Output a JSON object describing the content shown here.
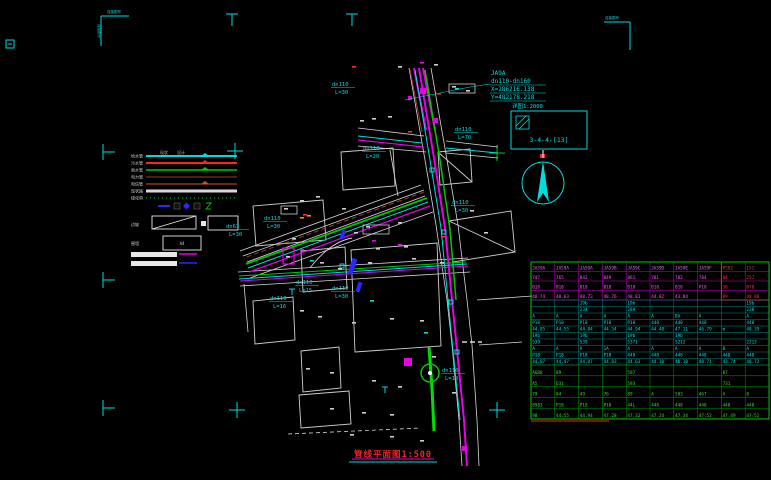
{
  "canvas": {
    "width": 771,
    "height": 480,
    "bg": "#000000"
  },
  "colors": {
    "cyan": "#00dcdc",
    "magenta": "#e800e8",
    "green": "#00c800",
    "red": "#ff2424",
    "white": "#dcdcdc",
    "blue": "#2828ff",
    "darkred": "#9a3b26",
    "orange": "#ff8c00"
  },
  "sheet": {
    "corner_label": "连接图号",
    "title": "管线平面图1:500"
  },
  "annotation": {
    "line1": "JA9A",
    "line2": "dn110-dn160",
    "line3": "X=286216.138",
    "line4": "Y=482178.218"
  },
  "detail_box": {
    "title": "详图1:2000",
    "code": "3-4-4-[13]"
  },
  "legend": {
    "headers": [
      "现状",
      "设计"
    ],
    "rows": [
      {
        "label": "给水管",
        "color": "#00dcdc",
        "w": 2,
        "dash": "",
        "marker": true
      },
      {
        "label": "污水管",
        "color": "#ff2424",
        "w": 2,
        "dash": "",
        "marker": true
      },
      {
        "label": "雨水管",
        "color": "#00c800",
        "w": 1.5,
        "dash": "",
        "marker": true
      },
      {
        "label": "电力管",
        "color": "#9a3b26",
        "w": 1,
        "dash": ""
      },
      {
        "label": "电信管",
        "color": "#d05028",
        "w": 1,
        "dash": "",
        "marker": true
      },
      {
        "label": "现状路",
        "color": "#d8d8d8",
        "w": 3,
        "dash": ""
      },
      {
        "label": "绿化带",
        "color": "#00b000",
        "w": 1.2,
        "dash": "1 3"
      }
    ],
    "box_row_label": "边坡",
    "wall_row_label": "围墙",
    "wall_box_text": "A4"
  },
  "pipe_labels": [
    {
      "d": "dn110",
      "l": "L=30",
      "x": 332,
      "y": 86
    },
    {
      "d": "dn110",
      "l": "L=20",
      "x": 363,
      "y": 150
    },
    {
      "d": "dn110",
      "l": "L=70",
      "x": 455,
      "y": 131
    },
    {
      "d": "dn110",
      "l": "L=30",
      "x": 264,
      "y": 220
    },
    {
      "d": "dn63",
      "l": "L=30",
      "x": 226,
      "y": 228
    },
    {
      "d": "dn110",
      "l": "L=15",
      "x": 296,
      "y": 284
    },
    {
      "d": "dn110",
      "l": "L=30",
      "x": 332,
      "y": 290
    },
    {
      "d": "dn110",
      "l": "L=30",
      "x": 452,
      "y": 204
    },
    {
      "d": "dn110",
      "l": "L=16",
      "x": 270,
      "y": 300
    },
    {
      "d": "dn110",
      "l": "L=10",
      "x": 442,
      "y": 372
    }
  ],
  "specks": {
    "white": [
      [
        360,
        120
      ],
      [
        372,
        118
      ],
      [
        388,
        116
      ],
      [
        300,
        200
      ],
      [
        316,
        196
      ],
      [
        342,
        208
      ],
      [
        354,
        232
      ],
      [
        398,
        222
      ],
      [
        404,
        246
      ],
      [
        376,
        248
      ],
      [
        286,
        256
      ],
      [
        320,
        262
      ],
      [
        338,
        268
      ],
      [
        368,
        262
      ],
      [
        412,
        258
      ],
      [
        440,
        262
      ],
      [
        300,
        310
      ],
      [
        318,
        316
      ],
      [
        352,
        322
      ],
      [
        390,
        318
      ],
      [
        420,
        320
      ],
      [
        306,
        368
      ],
      [
        330,
        372
      ],
      [
        372,
        380
      ],
      [
        398,
        386
      ],
      [
        330,
        408
      ],
      [
        362,
        412
      ],
      [
        390,
        414
      ],
      [
        432,
        356
      ],
      [
        452,
        392
      ],
      [
        420,
        440
      ],
      [
        390,
        436
      ],
      [
        350,
        434
      ],
      [
        398,
        66
      ],
      [
        434,
        64
      ],
      [
        466,
        90
      ],
      [
        470,
        210
      ],
      [
        484,
        232
      ],
      [
        292,
        238
      ],
      [
        452,
        86
      ],
      [
        366,
        226
      ],
      [
        284,
        208
      ]
    ],
    "red": [
      [
        408,
        131
      ],
      [
        441,
        236
      ],
      [
        303,
        214
      ],
      [
        437,
        93
      ],
      [
        352,
        66
      ]
    ],
    "orange": [
      [
        300,
        217
      ],
      [
        307,
        215
      ]
    ],
    "cyan": [
      [
        310,
        260
      ],
      [
        424,
        332
      ],
      [
        455,
        88
      ],
      [
        370,
        300
      ]
    ],
    "magenta": [
      [
        372,
        240
      ],
      [
        398,
        244
      ],
      [
        300,
        249
      ],
      [
        420,
        62
      ]
    ]
  },
  "table": {
    "x": 531,
    "y": 262,
    "w": 238,
    "sections": [
      {
        "name": "A",
        "line": "#cc00cc",
        "text": "#ff55ff",
        "rowH": 9.5,
        "rows": [
          [
            "JA59A",
            "JA59A",
            "JA59A",
            "JA59B",
            "JA59C",
            "JA59D",
            "JA59E",
            "JA59F",
            "P592",
            "151"
          ],
          [
            "747",
            "765",
            "842",
            "849",
            "861",
            "781",
            "782",
            "784",
            "84",
            "25J"
          ],
          [
            "B18",
            "B18",
            "B18",
            "B18",
            "B18",
            "B18",
            "B18",
            "P18",
            "36",
            "B78"
          ],
          [
            "48.74",
            "48.63",
            "48.73",
            "48.76",
            "48.81",
            "44.82",
            "43.84",
            "",
            "89",
            "48.88"
          ]
        ]
      },
      {
        "name": "B",
        "line": "#008888",
        "text": "#00e0e0",
        "rowH": 6.5,
        "rows": [
          [
            "",
            "",
            "19b",
            "",
            "19b",
            "",
            "",
            "",
            "",
            "19b"
          ],
          [
            "",
            "",
            "234",
            "",
            "289",
            "",
            "",
            "",
            "",
            "238"
          ],
          [
            "A",
            "A",
            "A",
            "A",
            "A",
            "A",
            "BA",
            "A",
            "",
            "A"
          ],
          [
            "P18",
            "P18",
            "P18",
            "P18",
            "P18",
            "448",
            "448",
            "448",
            "",
            "448"
          ],
          [
            "44.85",
            "44.55",
            "44.84",
            "44.34",
            "44.94",
            "44.48",
            "47.11",
            "46.79",
            "m",
            "48.39"
          ],
          [
            "19b",
            "",
            "19b",
            "",
            "19b",
            "",
            "19b",
            "",
            "",
            ""
          ],
          [
            "539",
            "",
            "539",
            "",
            "5371",
            "",
            "5212",
            "",
            "",
            "2213"
          ],
          [
            "A",
            "A",
            "A",
            "1A",
            "A",
            "A",
            "A",
            "A",
            "B",
            "A"
          ],
          [
            "P18",
            "P18",
            "P18",
            "P18",
            "448",
            "448",
            "448",
            "448",
            "448",
            "448"
          ],
          [
            "44.87",
            "44.47",
            "44.07",
            "44.83",
            "44.63",
            "44.10",
            "48.10",
            "48.71",
            "43.74",
            "48.72"
          ]
        ]
      },
      {
        "name": "C",
        "line": "#00a000",
        "text": "#33dd33",
        "rowH": 10.8,
        "rows": [
          [
            "A6B8",
            "89",
            "",
            "",
            "597",
            "",
            "",
            "",
            "87",
            ""
          ],
          [
            "A5",
            "D31",
            "",
            "",
            "593",
            "",
            "",
            "",
            "731",
            ""
          ],
          [
            "79",
            "84",
            "49",
            "76",
            "89",
            "A",
            "583",
            "467",
            "A",
            "8"
          ],
          [
            "8983",
            "P18",
            "P18",
            "P18",
            "44L",
            "448",
            "448",
            "448",
            "448",
            "448"
          ],
          [
            "98",
            "44.55",
            "44.94",
            "47.28",
            "47.32",
            "47.24",
            "47.34",
            "47.52",
            "47.49",
            "47.52"
          ]
        ]
      }
    ]
  }
}
